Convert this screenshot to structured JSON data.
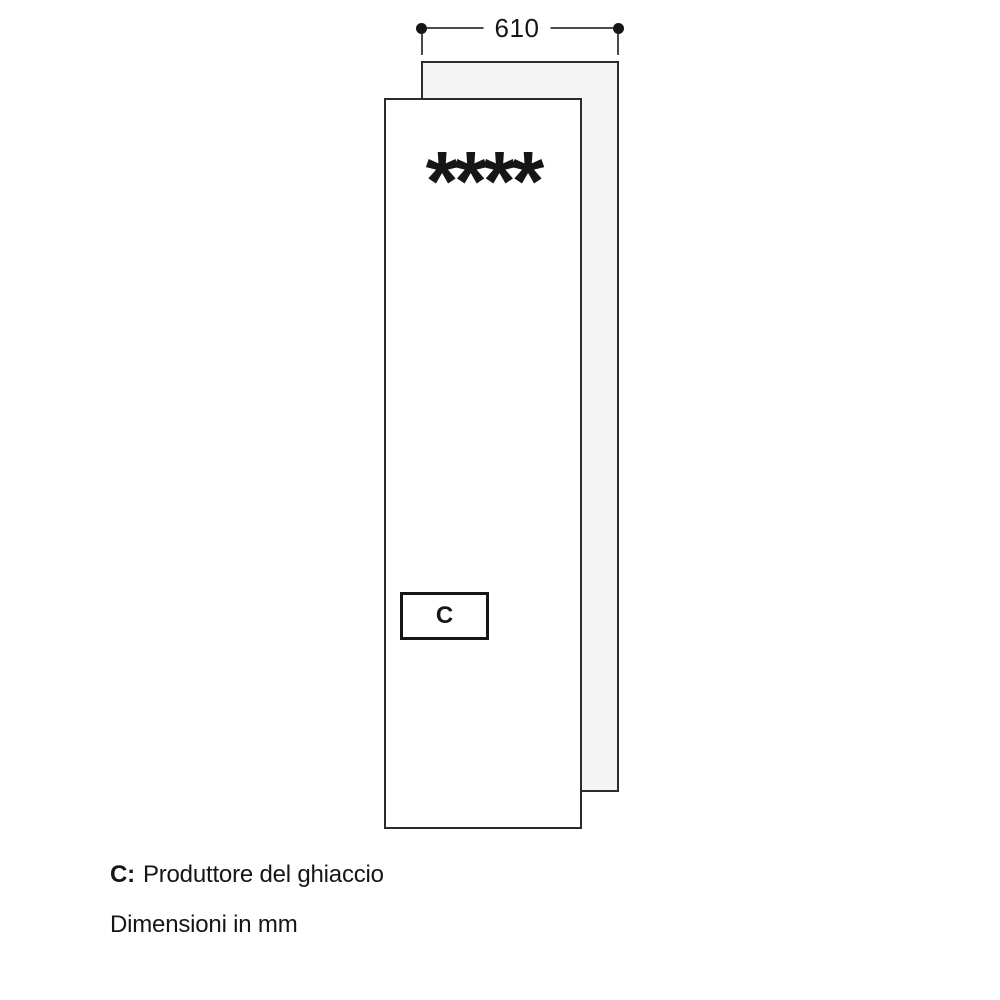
{
  "diagram": {
    "top_dimension": "610",
    "star_rating": "****",
    "compartment_label": "C"
  },
  "legend": {
    "key": "C:",
    "description": "Produttore del ghiaccio"
  },
  "footnote": "Dimensioni in mm",
  "colors": {
    "panel_outline": "#2b2b2b",
    "back_panel_fill": "#f4f4f4",
    "front_panel_fill": "#ffffff",
    "dimension_line": "#4a4a4a",
    "dimension_dot": "#161616",
    "text": "#161616",
    "background": "#ffffff"
  }
}
